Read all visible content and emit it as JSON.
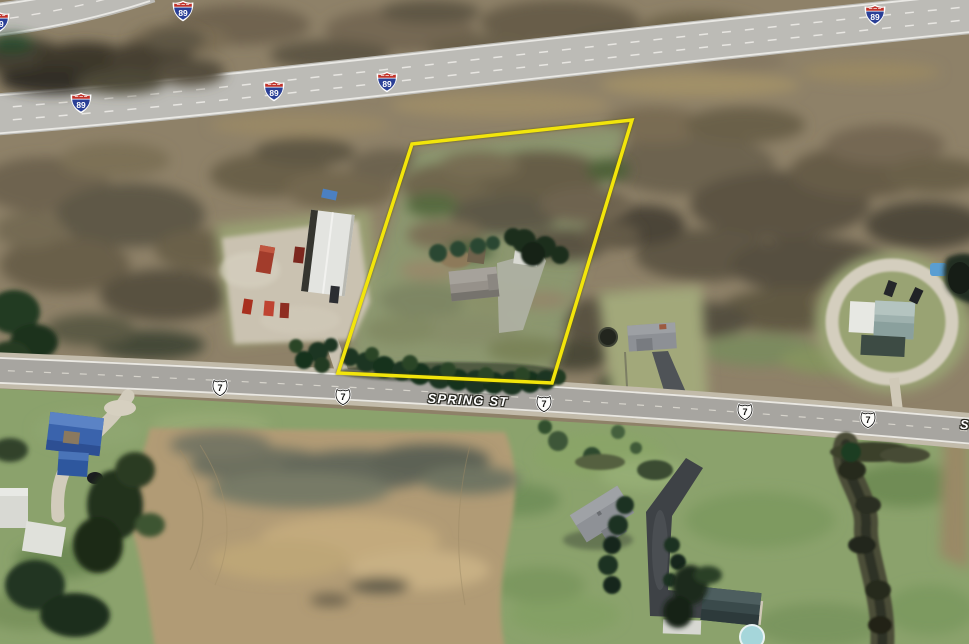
{
  "map": {
    "description": "Aerial imagery with highway and street overlays and a highlighted parcel boundary",
    "spring_street": {
      "label": "SPRING ST",
      "partial_label": "S"
    },
    "interstate_shields": [
      {
        "label": "89",
        "x": -1,
        "y": 22
      },
      {
        "label": "89",
        "x": 183,
        "y": 11
      },
      {
        "label": "89",
        "x": 81,
        "y": 103
      },
      {
        "label": "89",
        "x": 274,
        "y": 91
      },
      {
        "label": "89",
        "x": 387,
        "y": 82
      },
      {
        "label": "89",
        "x": 875,
        "y": 15
      }
    ],
    "us_route_shields": [
      {
        "label": "7",
        "x": 220,
        "y": 388
      },
      {
        "label": "7",
        "x": 343,
        "y": 397
      },
      {
        "label": "7",
        "x": 544,
        "y": 404
      },
      {
        "label": "7",
        "x": 745,
        "y": 412
      },
      {
        "label": "7",
        "x": 868,
        "y": 420
      }
    ],
    "parcel": {
      "points": "412,144 632,120 552,383 338,373"
    },
    "colors": {
      "parcel": "#f2e50b",
      "interstate_red": "#c03028",
      "interstate_blue": "#2a3f96",
      "us_shield_fill": "#fdfdfb",
      "us_shield_text": "#141412"
    }
  }
}
